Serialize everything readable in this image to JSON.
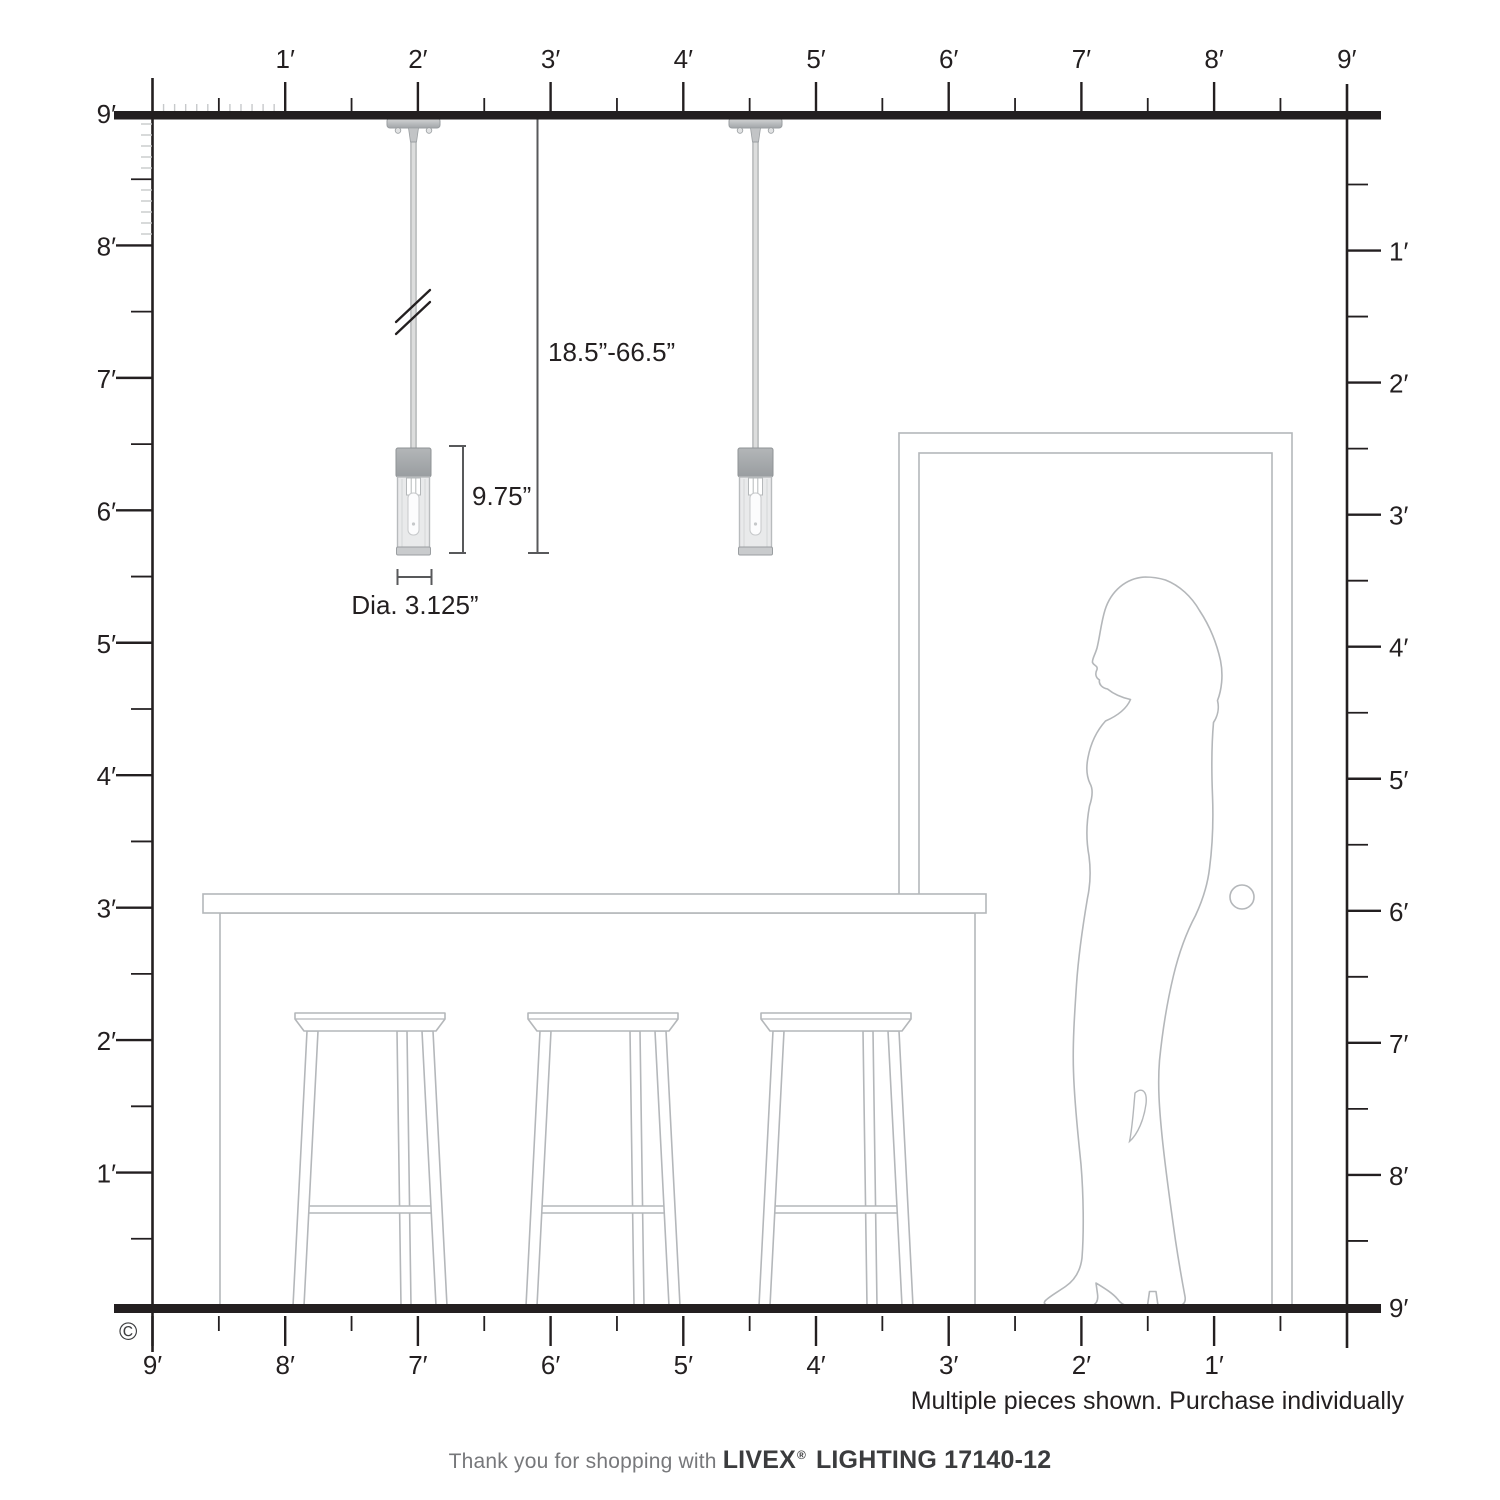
{
  "rulers": {
    "unit": "feet",
    "top": {
      "labels": [
        "1′",
        "2′",
        "3′",
        "4′",
        "5′",
        "6′",
        "7′",
        "8′",
        "9′"
      ]
    },
    "bottom": {
      "labels": [
        "9′",
        "8′",
        "7′",
        "6′",
        "5′",
        "4′",
        "3′",
        "2′",
        "1′"
      ]
    },
    "left": {
      "labels": [
        "9′",
        "8′",
        "7′",
        "6′",
        "5′",
        "4′",
        "3′",
        "2′",
        "1′"
      ]
    },
    "right": {
      "labels": [
        "1′",
        "2′",
        "3′",
        "4′",
        "5′",
        "6′",
        "7′",
        "8′",
        "9′"
      ]
    }
  },
  "dimensions": {
    "hang_range": "18.5”-66.5”",
    "fixture_height": "9.75”",
    "fixture_diameter": "Dia. 3.125”"
  },
  "note": "Multiple pieces shown. Purchase individually",
  "copyright": "©",
  "footer": {
    "thanks": "Thank you for shopping with ",
    "brand": "LIVEX",
    "registered": "®",
    "product": " LIGHTING 17140-12"
  },
  "colors": {
    "ink": "#231f20",
    "line_art": "#b4b7ba",
    "dimension_line": "#58595b"
  }
}
